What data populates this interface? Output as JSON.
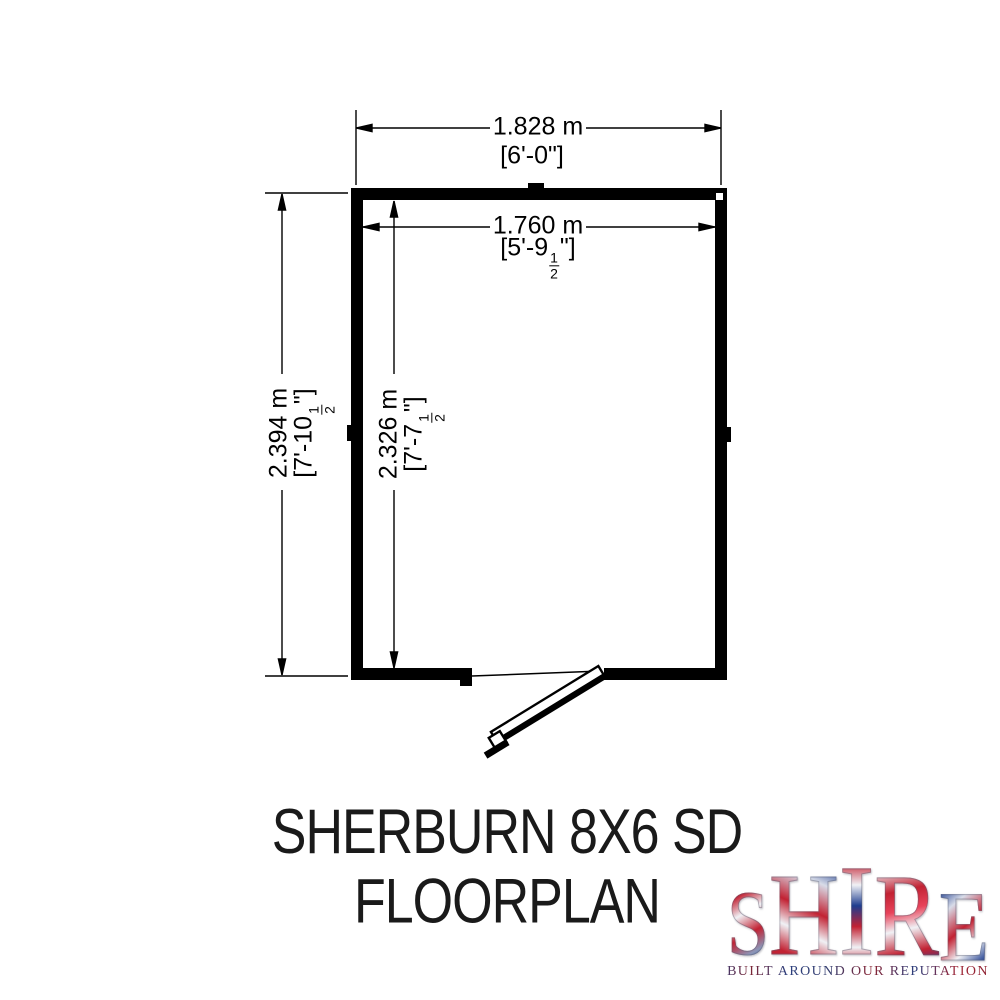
{
  "drawing": {
    "dim_width_outer": {
      "metric": "1.828 m",
      "imperial": "[6'-0\"]"
    },
    "dim_width_inner": {
      "metric": "1.760 m",
      "imperial_prefix": "[5'-9",
      "fraction_numerator": "1",
      "fraction_denominator": "2",
      "imperial_suffix": "\"]"
    },
    "dim_height_outer": {
      "metric": "2.394 m",
      "imperial_prefix": "[7'-10",
      "fraction_numerator": "1",
      "fraction_denominator": "2",
      "imperial_suffix": "\"]"
    },
    "dim_height_inner": {
      "metric": "2.326 m",
      "imperial_prefix": "[7'-7",
      "fraction_numerator": "1",
      "fraction_denominator": "2",
      "imperial_suffix": "\"]"
    }
  },
  "title": {
    "line1": "SHERBURN 8X6 SD",
    "line2": "FLOORPLAN"
  },
  "logo": {
    "letters": [
      "S",
      "H",
      "I",
      "R",
      "E"
    ],
    "tagline": "BUILT AROUND OUR REPUTATION",
    "flag_red": "#c22233",
    "flag_blue": "#1e3d8f",
    "flag_white": "#eef0f6"
  },
  "colors": {
    "wall": "#000000",
    "line": "#000000",
    "text": "#000000"
  }
}
